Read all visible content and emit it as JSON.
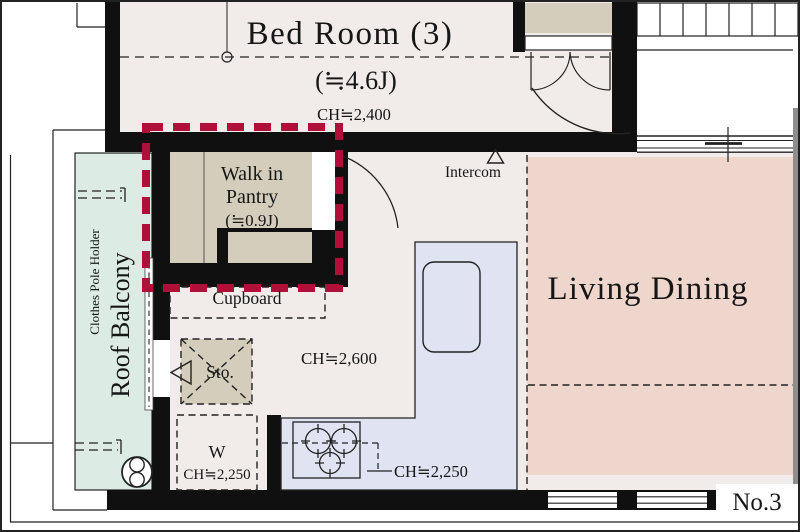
{
  "unit_label": "No.3",
  "bedroom": {
    "name": "Bed Room (3)",
    "size": "(≒4.6J)",
    "ceiling": "CH≒2,400"
  },
  "pantry": {
    "line1": "Walk in",
    "line2": "Pantry",
    "size": "(≒0.9J)"
  },
  "living_dining": {
    "name": "Living Dining"
  },
  "kitchen": {
    "ceiling": "CH≒2,600",
    "counter_ceiling": "CH≒2,250"
  },
  "cupboard_label": "Cupboard",
  "storage_label": "Sto.",
  "washer": {
    "label": "W",
    "ceiling": "CH≒2,250"
  },
  "intercom_label": "Intercom",
  "balcony": {
    "name": "Roof Balcony",
    "accessory": "Clothes Pole Holder"
  },
  "colors": {
    "floor": "#f1ece9",
    "closet_beige": "#d5cdbb",
    "living_pink": "#eed6cc",
    "counter_blue": "#dfe3f2",
    "balcony_mint": "#dcebe3",
    "highlight_red": "#b00f3a",
    "wall_black": "#101010"
  }
}
